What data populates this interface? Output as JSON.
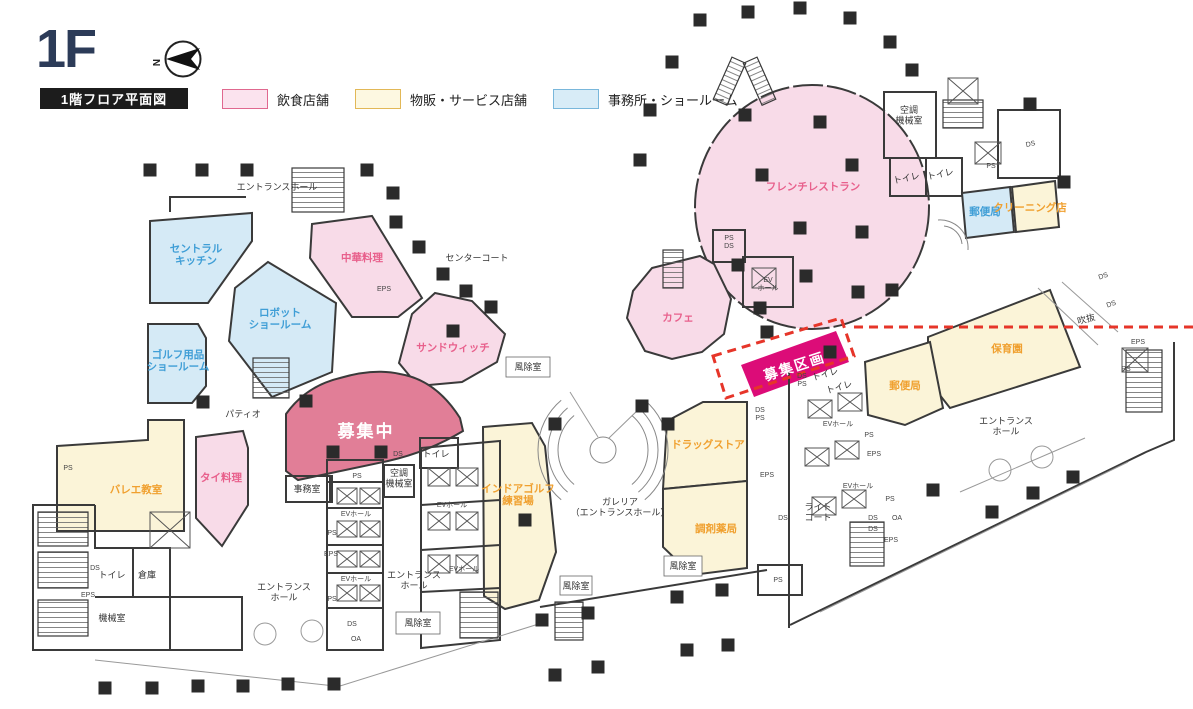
{
  "header": {
    "floor": "1F",
    "title": "1階フロア平面図",
    "compass_n": "N"
  },
  "legend": {
    "items": [
      {
        "label": "飲食店舗",
        "fill": "#fbe3ee",
        "border": "#e0688f"
      },
      {
        "label": "物販・サービス店舗",
        "fill": "#fdf8e1",
        "border": "#e2b857"
      },
      {
        "label": "事務所・ショールーム",
        "fill": "#d8ecf7",
        "border": "#79b7db"
      }
    ]
  },
  "palette": {
    "food_fill": "#f8dbe8",
    "retail_fill": "#fbf4d8",
    "office_fill": "#d5eaf6",
    "recruiting_fill": "#e17e97",
    "section_fill": "#dc0c78",
    "dashed": "#e63529",
    "wall": "#3a3a3a",
    "text_pink": "#e8608c",
    "text_orange": "#f0a02f",
    "text_blue": "#3f9ed6"
  },
  "plan": {
    "labels": [
      {
        "n": "label-central-kitchen",
        "t": "セントラル\nキッチン",
        "x": 196,
        "y": 252,
        "c": "blue"
      },
      {
        "n": "label-robot-showroom",
        "t": "ロボット\nショールーム",
        "x": 280,
        "y": 316,
        "c": "blue"
      },
      {
        "n": "label-golf-showroom",
        "t": "ゴルフ用品\nショールーム",
        "x": 178,
        "y": 358,
        "c": "blue"
      },
      {
        "n": "label-post-office-north",
        "t": "郵便局",
        "x": 985,
        "y": 215,
        "c": "blue",
        "s": 8
      },
      {
        "n": "label-chinese-restaurant",
        "t": "中華料理",
        "x": 362,
        "y": 261,
        "c": "pink"
      },
      {
        "n": "label-sandwich",
        "t": "サンドウィッチ",
        "x": 453,
        "y": 351,
        "c": "pink"
      },
      {
        "n": "label-french-restaurant",
        "t": "フレンチレストラン",
        "x": 813,
        "y": 190,
        "c": "pink"
      },
      {
        "n": "label-cafe",
        "t": "カフェ",
        "x": 678,
        "y": 321,
        "c": "pink"
      },
      {
        "n": "label-thai",
        "t": "タイ料理",
        "x": 221,
        "y": 481,
        "c": "pink",
        "s": 10
      },
      {
        "n": "label-recruiting",
        "t": "募集中",
        "x": 366,
        "y": 437,
        "c": "rose"
      },
      {
        "n": "label-recruiting-section",
        "t": "募集区画",
        "x": 796,
        "y": 371,
        "c": "mag",
        "r": -18
      },
      {
        "n": "label-ballet",
        "t": "バレエ教室",
        "x": 136,
        "y": 493,
        "c": "orange"
      },
      {
        "n": "label-indoor-golf",
        "t": "インドアゴルフ\n練習場",
        "x": 518,
        "y": 492,
        "c": "orange",
        "s": 9.5
      },
      {
        "n": "label-drugstore",
        "t": "ドラッグストア",
        "x": 708,
        "y": 448,
        "c": "orange",
        "s": 10
      },
      {
        "n": "label-pharmacy",
        "t": "調剤薬局",
        "x": 716,
        "y": 532,
        "c": "orange",
        "s": 9.5
      },
      {
        "n": "label-nursery",
        "t": "保育園",
        "x": 1007,
        "y": 352,
        "c": "orange"
      },
      {
        "n": "label-post-office-east",
        "t": "郵便局",
        "x": 905,
        "y": 389,
        "c": "orange",
        "s": 9
      },
      {
        "n": "label-cleaning",
        "t": "クリーニング店",
        "x": 1030,
        "y": 211,
        "c": "orange",
        "s": 6.5
      },
      {
        "n": "label-entrance-hall-nw",
        "t": "エントランスホール",
        "x": 277,
        "y": 190,
        "c": "area"
      },
      {
        "n": "label-center-court",
        "t": "センターコート",
        "x": 477,
        "y": 261,
        "c": "area"
      },
      {
        "n": "label-patio",
        "t": "パティオ",
        "x": 243,
        "y": 417,
        "c": "area"
      },
      {
        "n": "label-galleria",
        "t": "ガレリア\n（エントランスホール）",
        "x": 620,
        "y": 505,
        "c": "area"
      },
      {
        "n": "label-entrance-hall-sw",
        "t": "エントランス\nホール",
        "x": 284,
        "y": 590,
        "c": "area",
        "s": 8.5
      },
      {
        "n": "label-entrance-hall-center",
        "t": "エントランス\nホール",
        "x": 414,
        "y": 578,
        "c": "area",
        "s": 8.5
      },
      {
        "n": "label-entrance-hall-east",
        "t": "エントランス\nホール",
        "x": 1006,
        "y": 424,
        "c": "area",
        "s": 8.5
      },
      {
        "n": "label-light-court",
        "t": "ライト\nコート",
        "x": 818,
        "y": 510,
        "c": "area",
        "s": 8.5
      },
      {
        "n": "label-void",
        "t": "吹抜",
        "x": 1087,
        "y": 322,
        "c": "area",
        "s": 8,
        "r": -15
      },
      {
        "n": "label-machine-room",
        "t": "機械室",
        "x": 112,
        "y": 621,
        "c": "area",
        "s": 8
      },
      {
        "n": "label-ac-machine-room-ne",
        "t": "空調\n機械室",
        "x": 909,
        "y": 113,
        "c": "area",
        "s": 7
      },
      {
        "n": "label-ac-machine-room-center",
        "t": "空調\n機械室",
        "x": 399,
        "y": 476,
        "c": "area",
        "s": 6
      },
      {
        "n": "label-office-room",
        "t": "事務室",
        "x": 307,
        "y": 492,
        "c": "area",
        "s": 7.5
      },
      {
        "n": "label-storage",
        "t": "倉庫",
        "x": 147,
        "y": 578,
        "c": "area",
        "s": 7
      },
      {
        "n": "label-toilet-sw",
        "t": "トイレ",
        "x": 112,
        "y": 578,
        "c": "area",
        "s": 7
      },
      {
        "n": "label-toilet-center",
        "t": "トイレ",
        "x": 436,
        "y": 457,
        "c": "area",
        "s": 7
      },
      {
        "n": "label-toilet-ne-1",
        "t": "トイレ",
        "x": 907,
        "y": 181,
        "c": "area",
        "s": 7,
        "r": -12
      },
      {
        "n": "label-toilet-ne-2",
        "t": "トイレ",
        "x": 941,
        "y": 177,
        "c": "area",
        "s": 7,
        "r": -12
      },
      {
        "n": "label-toilet-e-1",
        "t": "トイレ",
        "x": 826,
        "y": 377,
        "c": "area",
        "s": 6,
        "r": -16
      },
      {
        "n": "label-toilet-e-2",
        "t": "トイレ",
        "x": 840,
        "y": 390,
        "c": "area",
        "s": 6,
        "r": -16
      },
      {
        "n": "label-windbreak-sw",
        "t": "風除室",
        "x": 418,
        "y": 626,
        "c": "area",
        "s": 7
      },
      {
        "n": "label-windbreak-s1",
        "t": "風除室",
        "x": 576,
        "y": 589,
        "c": "area",
        "s": 5.5
      },
      {
        "n": "label-windbreak-s2",
        "t": "風除室",
        "x": 683,
        "y": 569,
        "c": "area",
        "s": 5.5
      },
      {
        "n": "label-windbreak-center",
        "t": "風除室",
        "x": 528,
        "y": 370,
        "c": "area",
        "s": 7
      },
      {
        "n": "utility-label",
        "t": "PS",
        "x": 68,
        "y": 470,
        "c": "util"
      },
      {
        "n": "utility-label",
        "t": "DS",
        "x": 95,
        "y": 570,
        "c": "util",
        "s": 6.5
      },
      {
        "n": "utility-label",
        "t": "EPS",
        "x": 88,
        "y": 597,
        "c": "util",
        "s": 6.5
      },
      {
        "n": "utility-label",
        "t": "PS",
        "x": 357,
        "y": 478,
        "c": "util"
      },
      {
        "n": "utility-label",
        "t": "EVホール",
        "x": 356,
        "y": 516,
        "c": "util"
      },
      {
        "n": "utility-label",
        "t": "PS",
        "x": 332,
        "y": 535,
        "c": "util",
        "s": 6.5
      },
      {
        "n": "utility-label",
        "t": "EPS",
        "x": 331,
        "y": 556,
        "c": "util",
        "s": 6.5
      },
      {
        "n": "utility-label",
        "t": "EVホール",
        "x": 356,
        "y": 581,
        "c": "util"
      },
      {
        "n": "utility-label",
        "t": "PS",
        "x": 332,
        "y": 601,
        "c": "util",
        "s": 6.5
      },
      {
        "n": "utility-label",
        "t": "DS",
        "x": 352,
        "y": 626,
        "c": "util",
        "s": 6
      },
      {
        "n": "utility-label",
        "t": "OA",
        "x": 356,
        "y": 641,
        "c": "util",
        "s": 6.5
      },
      {
        "n": "utility-label",
        "t": "DS",
        "x": 398,
        "y": 456,
        "c": "util",
        "s": 6.5
      },
      {
        "n": "utility-label",
        "t": "EVホール",
        "x": 452,
        "y": 507,
        "c": "util"
      },
      {
        "n": "utility-label",
        "t": "EVホール",
        "x": 464,
        "y": 571,
        "c": "util"
      },
      {
        "n": "utility-label",
        "t": "PS\nDS",
        "x": 729,
        "y": 240,
        "c": "util"
      },
      {
        "n": "utility-label",
        "t": "EV\nホール",
        "x": 768,
        "y": 282,
        "c": "util",
        "s": 6
      },
      {
        "n": "utility-label",
        "t": "DS\nPS",
        "x": 760,
        "y": 412,
        "c": "util"
      },
      {
        "n": "utility-label",
        "t": "EPS",
        "x": 767,
        "y": 477,
        "c": "util"
      },
      {
        "n": "utility-label",
        "t": "DS",
        "x": 783,
        "y": 520,
        "c": "util"
      },
      {
        "n": "utility-label",
        "t": "PS",
        "x": 778,
        "y": 582,
        "c": "util"
      },
      {
        "n": "utility-label",
        "t": "DS\nPS",
        "x": 802,
        "y": 378,
        "c": "util",
        "s": 5.5
      },
      {
        "n": "utility-label",
        "t": "EVホール",
        "x": 838,
        "y": 426,
        "c": "util",
        "s": 6.5
      },
      {
        "n": "utility-label",
        "t": "PS",
        "x": 869,
        "y": 437,
        "c": "util",
        "s": 6
      },
      {
        "n": "utility-label",
        "t": "EPS",
        "x": 874,
        "y": 456,
        "c": "util",
        "s": 6
      },
      {
        "n": "utility-label",
        "t": "EVホール",
        "x": 858,
        "y": 488,
        "c": "util",
        "s": 6.5
      },
      {
        "n": "utility-label",
        "t": "PS",
        "x": 890,
        "y": 501,
        "c": "util",
        "s": 6
      },
      {
        "n": "utility-label",
        "t": "DS",
        "x": 873,
        "y": 520,
        "c": "util",
        "s": 5.5
      },
      {
        "n": "utility-label",
        "t": "DS",
        "x": 873,
        "y": 531,
        "c": "util",
        "s": 5.5
      },
      {
        "n": "utility-label",
        "t": "OA",
        "x": 897,
        "y": 520,
        "c": "util",
        "s": 6
      },
      {
        "n": "utility-label",
        "t": "EPS",
        "x": 891,
        "y": 542,
        "c": "util",
        "s": 6
      },
      {
        "n": "utility-label",
        "t": "EPS",
        "x": 1138,
        "y": 344,
        "c": "util"
      },
      {
        "n": "utility-label",
        "t": "PS",
        "x": 1126,
        "y": 371,
        "c": "util"
      },
      {
        "n": "utility-label",
        "t": "DS",
        "x": 1104,
        "y": 278,
        "c": "util",
        "s": 6,
        "r": -20
      },
      {
        "n": "utility-label",
        "t": "DS",
        "x": 1112,
        "y": 306,
        "c": "util",
        "s": 6,
        "r": -20
      },
      {
        "n": "utility-label",
        "t": "DS",
        "x": 1031,
        "y": 146,
        "c": "util",
        "s": 7,
        "r": -12
      },
      {
        "n": "utility-label",
        "t": "PS",
        "x": 991,
        "y": 168,
        "c": "util",
        "s": 6
      },
      {
        "n": "utility-label",
        "t": "EPS",
        "x": 384,
        "y": 291,
        "c": "util",
        "s": 6.5
      }
    ]
  }
}
